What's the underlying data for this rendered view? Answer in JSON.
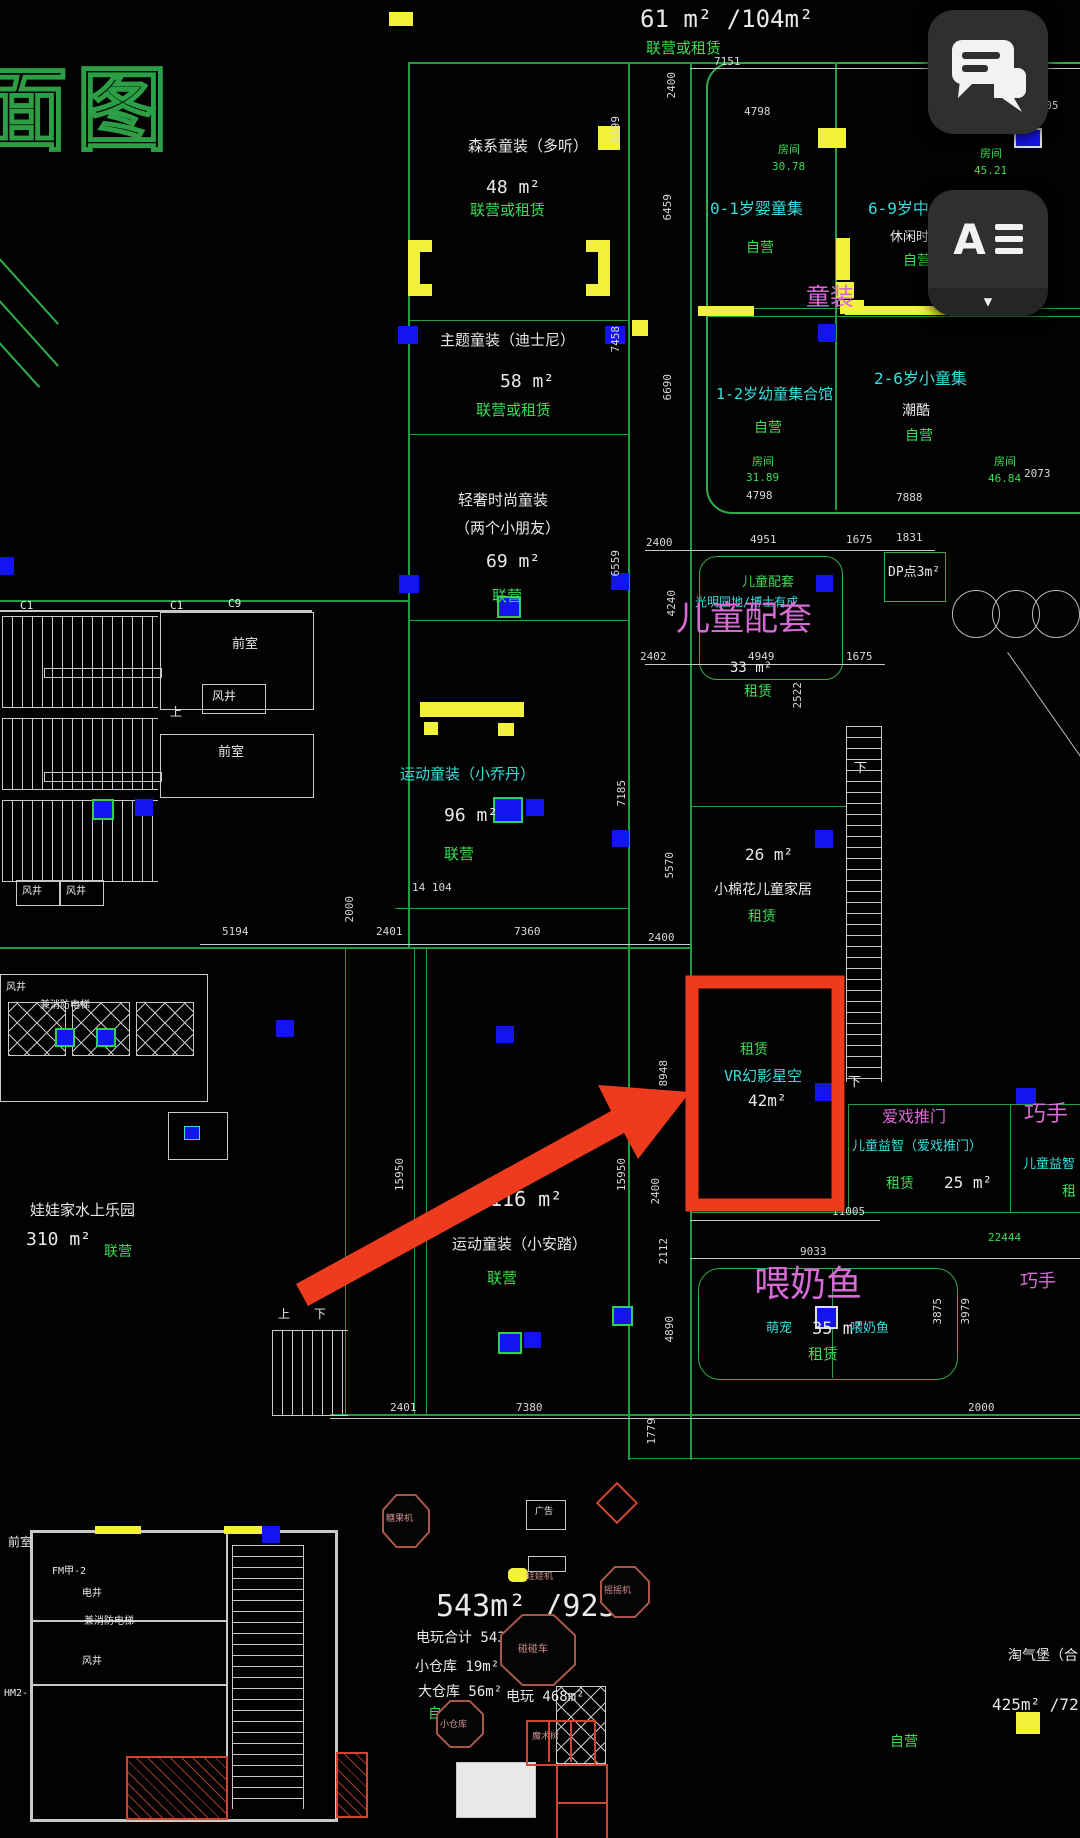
{
  "ui": {
    "chat_button": "chat",
    "reader_letter": "A",
    "dropdown_arrow": "▼"
  },
  "title_partial": "面图",
  "top_header": {
    "area": "61 m² /104m²",
    "mode": "联营或租赁"
  },
  "shops": {
    "senxi": {
      "name": "森系童装（多听）",
      "area": "48 m²",
      "mode": "联营或租赁"
    },
    "zhuti": {
      "name": "主题童装（迪士尼）",
      "area": "58 m²",
      "mode": "联营或租赁"
    },
    "qingshe": {
      "name": "轻奢时尚童装",
      "name2": "（两个小朋友）",
      "area": "69 m²",
      "mode": "联营"
    },
    "xiaoqiaodan": {
      "name": "运动童装（小乔丹）",
      "area": "96 m²",
      "mode": "联营"
    },
    "xiaoanta": {
      "name": "运动童装（小安踏）",
      "area": "116 m²",
      "mode": "联营"
    },
    "wawajia": {
      "name": "娃娃家水上乐园",
      "area": "310 m²",
      "mode": "联营"
    }
  },
  "rooms": {
    "banner": "童装",
    "baby": {
      "name": "0-1岁婴童集",
      "mode": "自营",
      "tag": "房间",
      "tag_value": "30.78"
    },
    "mid": {
      "name": "6-9岁中",
      "sub": "休闲时装",
      "mode": "自营",
      "tag": "房间",
      "tag_value": "45.21"
    },
    "toddler": {
      "name": "1-2岁幼童集合馆",
      "mode": "自营",
      "tag": "房间",
      "tag_value": "31.89"
    },
    "small": {
      "name": "2-6岁小童集",
      "sub": "潮酷",
      "mode": "自营",
      "tag": "房间",
      "tag_value": "46.84"
    }
  },
  "support": {
    "kids_small": "儿童配套",
    "kids_sub": "光明园地/博士有成",
    "kids_big": "儿童配套",
    "kids_area": "33 m²",
    "kids_mode": "租赁",
    "dp": "DP点3m²",
    "cotton": {
      "area": "26 m²",
      "name": "小棉花儿童家居",
      "mode": "租赁"
    },
    "vr": {
      "mode": "租赁",
      "name": "VR幻影星空",
      "area": "42m²"
    },
    "aixi": {
      "title": "爱戏推门",
      "name": "儿童益智（爱戏推门）",
      "mode": "租赁",
      "area": "25 m²"
    },
    "qiaoshou": {
      "title": "巧手",
      "name": "儿童益智（",
      "mode": "租"
    },
    "qiaoshou2": "巧手",
    "weinaiyu": {
      "title": "喂奶鱼",
      "left": "萌宠",
      "area": "35 m²",
      "right": "喂奶鱼",
      "mode": "租赁"
    },
    "taoqibao": {
      "name": "淘气堡（合",
      "area": "425m² /72",
      "mode": "自营"
    }
  },
  "arcade": {
    "headline": "543m² /923m²",
    "line1": "电玩合计 543m²",
    "line2": "小仓库 19m²",
    "line3": "大仓库 56m²",
    "line4": "电玩 468m²",
    "mode": "自营",
    "f1": "娃娃机",
    "f2": "摇摇机",
    "f3": "碰碰车",
    "f4": "小仓库",
    "f5": "魔术树",
    "f6": "广告",
    "f7": "糖果机"
  },
  "structure": {
    "c1a": "C1",
    "c1b": "C1",
    "c9": "C9",
    "qianshi1": "前室",
    "fengjing1": "风井",
    "qianshi2": "前室",
    "fengjing2": "风井",
    "fengjing3": "风井",
    "shang1": "上",
    "fengjing4": "风井",
    "elev1": "兼消防电梯",
    "qianshi3": "前室",
    "fm": "FM甲-2",
    "dianjing": "电井",
    "elev2": "兼消防电梯",
    "fengjing5": "风井",
    "hm": "HM2-",
    "shang2": "上",
    "xia2": "下",
    "xia3": "下",
    "xia4": "下"
  },
  "dims": [
    "7151",
    "2400",
    "4798",
    "2105",
    "6199",
    "6459",
    "7458",
    "6690",
    "2073",
    "7888",
    "4798",
    "2400",
    "4951",
    "1675",
    "1831",
    "4240",
    "6559",
    "2402",
    "4949",
    "1675",
    "2522",
    "5570",
    "7185",
    "14 104",
    "5194",
    "2000",
    "2401",
    "7360",
    "2400",
    "8948",
    "2400",
    "15950",
    "15950",
    "11005",
    "9033",
    "2112",
    "4890",
    "3875",
    "3979",
    "22444",
    "2401",
    "7380",
    "2000",
    "1779"
  ]
}
